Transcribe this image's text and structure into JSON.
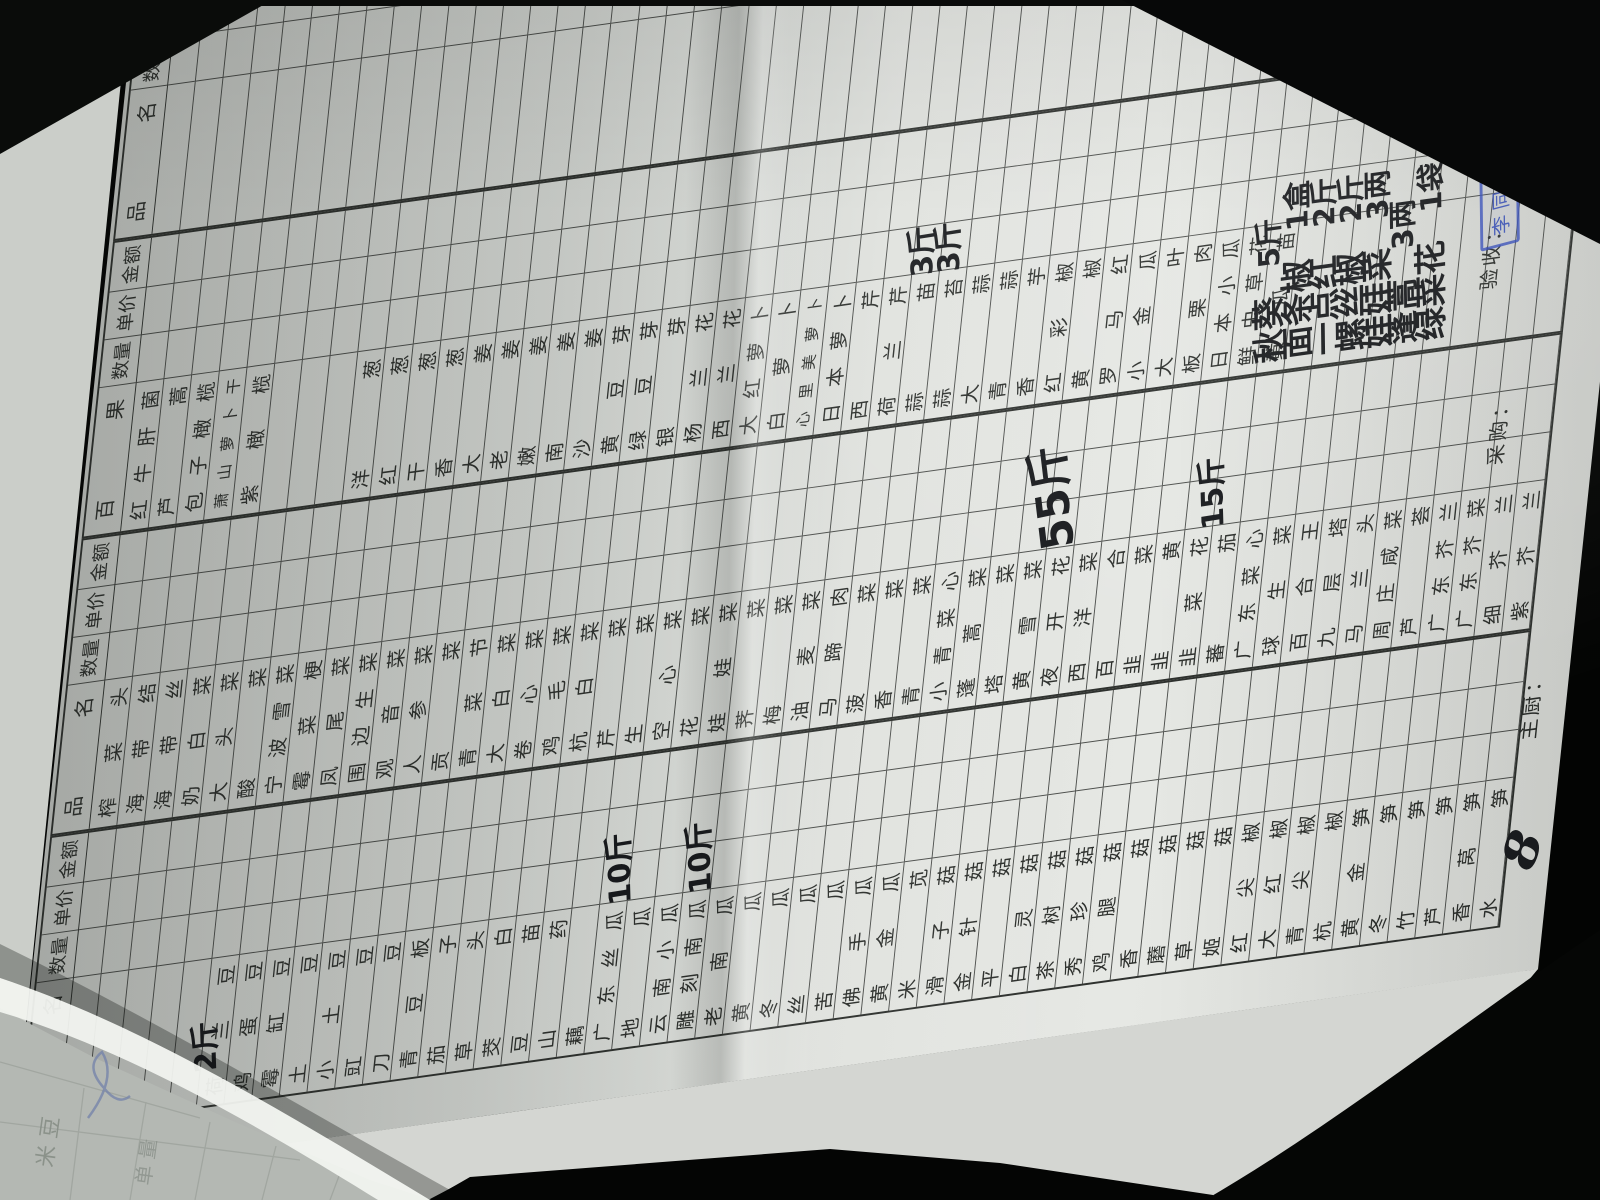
{
  "form": {
    "column_headers": [
      "品 名",
      "数量",
      "单价",
      "金 额"
    ],
    "groups": [
      {
        "id": "A",
        "name_header": "品 名",
        "items": [
          "",
          "",
          "",
          "",
          "",
          "荷兰豆",
          "鸡蛋豆",
          "霉缸豆",
          "土豆",
          "小土豆",
          "豇豆",
          "刀豆",
          "青豆板",
          "茄子",
          "草头",
          "茭白",
          "豆苗",
          "山药",
          "藕",
          "广东丝瓜",
          "地瓜",
          "云南小瓜",
          "雕刻南瓜",
          "老南瓜",
          "黄瓜",
          "冬瓜",
          "丝瓜",
          "苦瓜",
          "佛手瓜",
          "黄金瓜",
          "米苋",
          "滑子菇",
          "金针菇",
          "平菇",
          "白灵菇",
          "茶树菇",
          "秀珍菇",
          "鸡腿菇",
          "香菇",
          "蘑菇",
          "草菇",
          "姬菇",
          "红尖椒",
          "大红椒",
          "青尖椒",
          "杭椒",
          "黄金笋",
          "冬笋",
          "竹笋",
          "芦笋",
          "香莴笋",
          "水笋"
        ]
      },
      {
        "id": "B",
        "name_header": "品 名",
        "items": [
          "榨菜头",
          "海带结",
          "海带丝",
          "奶白菜",
          "大头菜",
          "酸菜",
          "宁波雪菜",
          "霉菜梗",
          "凤尾菜",
          "围边生菜",
          "观音菜",
          "人参菜",
          "贡菜",
          "青菜节",
          "大白菜",
          "卷心菜",
          "鸡毛菜",
          "杭白菜",
          "芹菜",
          "生菜",
          "空心菜",
          "花菜",
          "娃娃菜",
          "荠菜",
          "梅菜",
          "油麦菜",
          "马蹄肉",
          "菠菜",
          "香菜",
          "青菜",
          "小青菜心",
          "蓬蒿菜",
          "塔菜",
          "黄雪菜",
          "夜开花",
          "西洋菜",
          "百合",
          "韭菜",
          "韭黄",
          "韭菜花",
          "蕃茄",
          "广东菜心",
          "球生菜",
          "百合王",
          "九层塔",
          "马兰头",
          "周庄咸菜",
          "芦荟",
          "广东芥兰",
          "广东芥菜",
          "细芥兰",
          "紫芥兰"
        ]
      },
      {
        "id": "C",
        "name_header": "百 果",
        "items": [
          "红牛肝菌",
          "芦蒿",
          "包子橄榄",
          "萧山萝卜干",
          "紫橄榄",
          "",
          "",
          "",
          "洋葱",
          "红葱",
          "干葱",
          "香葱",
          "大姜",
          "老姜",
          "嫩姜",
          "南姜",
          "沙姜",
          "黄豆芽",
          "绿豆芽",
          "银芽",
          "杨兰花",
          "西兰花",
          "大红萝卜",
          "白萝卜",
          "心里美萝卜",
          "日本萝卜",
          "西芹",
          "荷兰芹",
          "蒜苗",
          "蒜苔",
          "大蒜",
          "青蒜",
          "香芋",
          "红彩椒",
          "黄椒",
          "罗马红",
          "小金瓜",
          "大叶",
          "板栗肉",
          "日本小瓜",
          "鲜虫草花",
          "黄瓜苗",
          "",
          "",
          "",
          "",
          "",
          "",
          "",
          "",
          "",
          ""
        ]
      },
      {
        "id": "D",
        "name_header": "品 名",
        "items": [
          "",
          "",
          "",
          "",
          "",
          "",
          "",
          "",
          "",
          "",
          "",
          "",
          "",
          "",
          "",
          "",
          "",
          "",
          "",
          "",
          "",
          "",
          "",
          "",
          "",
          "",
          "",
          "",
          "",
          "",
          "",
          "",
          "",
          "",
          "",
          "",
          "",
          "",
          "",
          "",
          "",
          "",
          "",
          "",
          "",
          "",
          "",
          "",
          "",
          "",
          "",
          ""
        ]
      }
    ],
    "handwritten_quantities": [
      {
        "group": 0,
        "row": 6,
        "col": "name",
        "text": "2斤",
        "big": false
      },
      {
        "group": 0,
        "row": 21,
        "col": "qty",
        "text": "10斤",
        "big": false
      },
      {
        "group": 0,
        "row": 24,
        "col": "qty",
        "text": "10斤",
        "big": false
      },
      {
        "group": 1,
        "row": 36,
        "col": "qty",
        "text": "55斤",
        "big": true
      },
      {
        "group": 1,
        "row": 42,
        "col": "qty",
        "text": "15斤",
        "big": false
      },
      {
        "group": 2,
        "row": 30,
        "col": "qty",
        "text": "3斤",
        "big": false
      },
      {
        "group": 2,
        "row": 31,
        "col": "qty",
        "text": "3斤",
        "big": false
      }
    ],
    "handwritten_items": [
      {
        "group": 2,
        "row": 43,
        "name": "秋葵",
        "qty": "5斤"
      },
      {
        "group": 2,
        "row": 44,
        "name": "面条椒",
        "qty": "1盒"
      },
      {
        "group": 2,
        "row": 45,
        "name": "一点红",
        "qty": "2斤"
      },
      {
        "group": 2,
        "row": 46,
        "name": "螺丝椒",
        "qty": "2斤"
      },
      {
        "group": 2,
        "row": 47,
        "name": "娃娃菜",
        "qty": "3两"
      },
      {
        "group": 2,
        "row": 48,
        "name": "蓬蒿",
        "qty": "3两"
      },
      {
        "group": 2,
        "row": 49,
        "name": "绿菜花",
        "qty": "1袋"
      }
    ],
    "footer": {
      "chef_label": "主厨：",
      "purchaser_label": "采购：",
      "inspector_label": "验收：",
      "stamp_text": "李同仁",
      "signature": "8"
    }
  },
  "under_sheet": {
    "faint_text_1": "米 豆",
    "faint_text_2": "单 量"
  }
}
